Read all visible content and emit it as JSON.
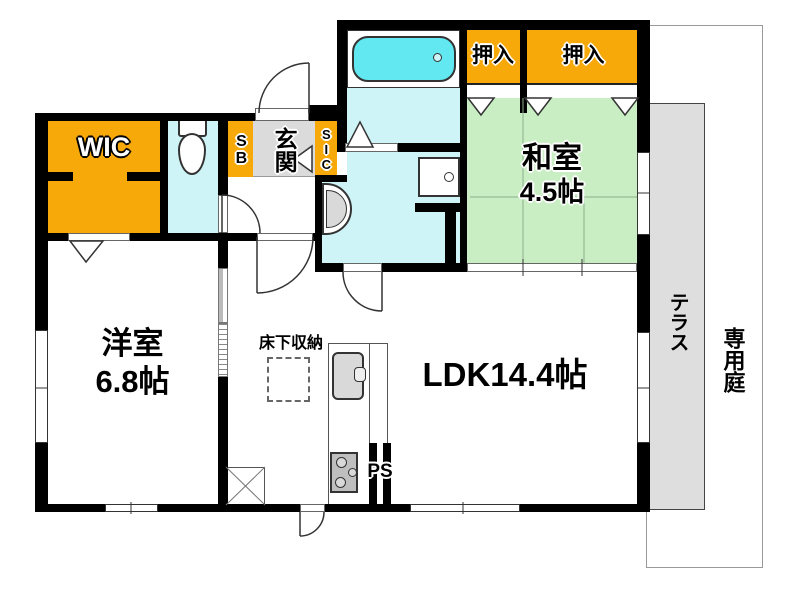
{
  "plan": {
    "labels": {
      "wic": "WIC",
      "oshiire": [
        "押入",
        "押入"
      ],
      "washitsu_name": "和室",
      "washitsu_size": "4.5帖",
      "youshitsu_name": "洋室",
      "youshitsu_size": "6.8帖",
      "ldk": "LDK14.4帖",
      "genkan": "玄関",
      "sb": "SB",
      "sic": "SIC",
      "floor_storage": "床下収納",
      "pipe_space": "PS",
      "terrace": "テラス",
      "private_garden": "専用庭"
    },
    "colors": {
      "closet_orange": "#F7A90A",
      "tatami_green": "#C9EEC4",
      "water_cyan": "#CEF4F7",
      "bathtub_cyan": "#62E8F0",
      "entry_gray": "#DBDBDB",
      "terrace_gray": "#DEDEDE",
      "wall_black": "#000000"
    }
  }
}
